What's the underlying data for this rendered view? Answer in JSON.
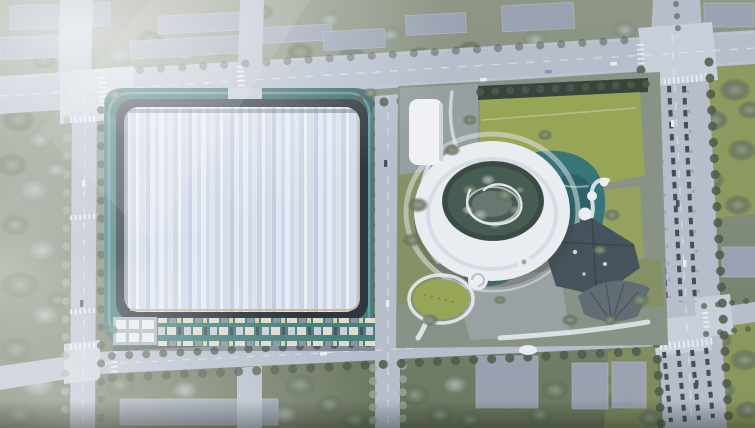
{
  "scene": {
    "type": "aerial-architectural-rendering",
    "title": "Campus master plan aerial rendering",
    "description": "Bird's-eye rendering of a development site: a large rectangular hall with a pale blue striped roof on a dark frame and teal podium (west block), a retail strip of small units along its south edge, and an east campus with a white ring-shaped building around a planted courtyard, teal ponds, bright lawns, curved white paths, a dark angular pavilion with a ribbed fan roof, a round lawn and a spiral pavilion. Surrounding: a top arterial road, left and center vertical streets, a wide right avenue with angled parking bays, hazy grey building slabs, tree blocks and white fog bloom over the left side.",
    "visible_text": "none",
    "elements": {
      "west_campus": [
        "teal-podium",
        "dark-roof-frame",
        "striped-roof-hall",
        "gold-roof-trim",
        "retail-strip-units",
        "white-grid-block",
        "entrance-stub"
      ],
      "east_campus": [
        "ring-building",
        "courtyard-garden",
        "white-rect-building",
        "top-lawn",
        "teal-ponds",
        "round-lawn",
        "spiral-pavilion",
        "node-path",
        "dark-angular-building",
        "fan-roof",
        "curved-paths",
        "south-plaza"
      ],
      "context": [
        "top-arterial-road",
        "left-street",
        "center-street",
        "right-avenue",
        "parking-bays",
        "bottom-road",
        "east-branch-road",
        "grey-slab-buildings",
        "tree-blocks",
        "street-tree-rows",
        "crosswalks",
        "cars",
        "fog-bloom"
      ]
    }
  },
  "palette": {
    "ground_base": "#848d77",
    "ground_dark": "#5f6a55",
    "road_fill": "#b6bdcb",
    "road_light": "#c9cfdb",
    "lane_white": "#f2f4f8",
    "tree_dark": "#46513f",
    "tree_mid": "#6d7a64",
    "tree_frost": "#9aa49b",
    "lawn_bright": "#94a24d",
    "lawn_mid": "#7f8c55",
    "lawn_east": "#8a9752",
    "apron_teal": "#3a7678",
    "apron_teal_dark": "#2a5c60",
    "frame_dark": "#202b33",
    "roof_light": "#e9edf5",
    "roof_mid": "#ccd5e6",
    "roof_trim_gold": "#c9b189",
    "strip_base": "#3f7a76",
    "unit_cream": "#e9e3d0",
    "unit_yellow": "#e2d5a2",
    "unit_gray": "#87919a",
    "ring_white": "#edeff4",
    "ring_shadow": "#c7ccd6",
    "courtyard_green": "#3d5347",
    "pond_teal": "#2e6d70",
    "pond_deep": "#1d4e54",
    "dark_building": "#3b4a52",
    "dark_building_edge": "#2b373e",
    "fan_roof": "#59646c",
    "plaza_gray": "#9aa2a6",
    "slab_gray": "#9aa2b4",
    "slab_edge": "#b7bdca",
    "car_white": "#eceef2",
    "car_dark": "#3f474f",
    "fog_white": "#f4f7fb"
  }
}
